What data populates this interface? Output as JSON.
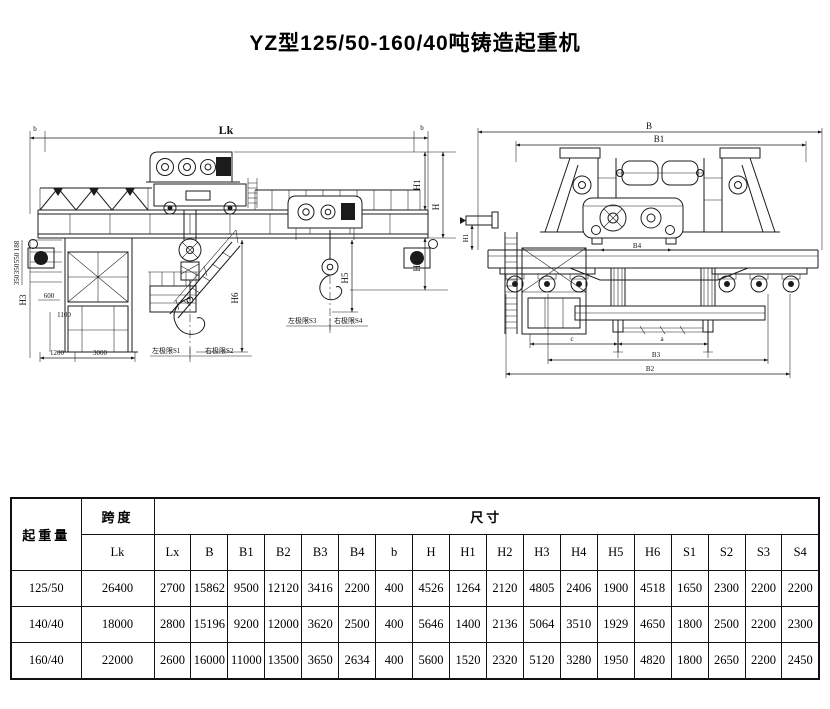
{
  "title": "YZ型125/50-160/40吨铸造起重机",
  "front_view": {
    "lk": "Lk",
    "b_left": "b",
    "b_right": "b",
    "h1": "H1",
    "h": "H",
    "h2": "H2",
    "h3": "H3",
    "h5": "H5",
    "h6": "H6",
    "d188": "188",
    "d550": "550",
    "d350a": "350",
    "d350b": "350",
    "d600": "600",
    "d1100": "1100",
    "d1200": "1200",
    "d3000": "3000",
    "s1_label": "左极限S1",
    "s2_label": "右极限S2",
    "s3_label": "左极限S3",
    "s4_label": "右极限S4"
  },
  "side_view": {
    "b": "B",
    "b1": "B1",
    "b2": "B2",
    "b3": "B3",
    "b4": "B4",
    "a": "a",
    "c": "c",
    "h1": "H1"
  },
  "table": {
    "capacity_header": "起重量",
    "span_header": "跨度",
    "span_sub": "Lk",
    "size_header": "尺寸",
    "dim_cols": [
      "Lx",
      "B",
      "B1",
      "B2",
      "B3",
      "B4",
      "b",
      "H",
      "H1",
      "H2",
      "H3",
      "H4",
      "H5",
      "H6",
      "S1",
      "S2",
      "S3",
      "S4"
    ],
    "rows": [
      {
        "capacity": "125/50",
        "lk": "26400",
        "values": [
          "2700",
          "15862",
          "9500",
          "12120",
          "3416",
          "2200",
          "400",
          "4526",
          "1264",
          "2120",
          "4805",
          "2406",
          "1900",
          "4518",
          "1650",
          "2300",
          "2200",
          "2200"
        ]
      },
      {
        "capacity": "140/40",
        "lk": "18000",
        "values": [
          "2800",
          "15196",
          "9200",
          "12000",
          "3620",
          "2500",
          "400",
          "5646",
          "1400",
          "2136",
          "5064",
          "3510",
          "1929",
          "4650",
          "1800",
          "2500",
          "2200",
          "2300"
        ]
      },
      {
        "capacity": "160/40",
        "lk": "22000",
        "values": [
          "2600",
          "16000",
          "11000",
          "13500",
          "3650",
          "2634",
          "400",
          "5600",
          "1520",
          "2320",
          "5120",
          "3280",
          "1950",
          "4820",
          "1800",
          "2650",
          "2200",
          "2450"
        ]
      }
    ]
  }
}
